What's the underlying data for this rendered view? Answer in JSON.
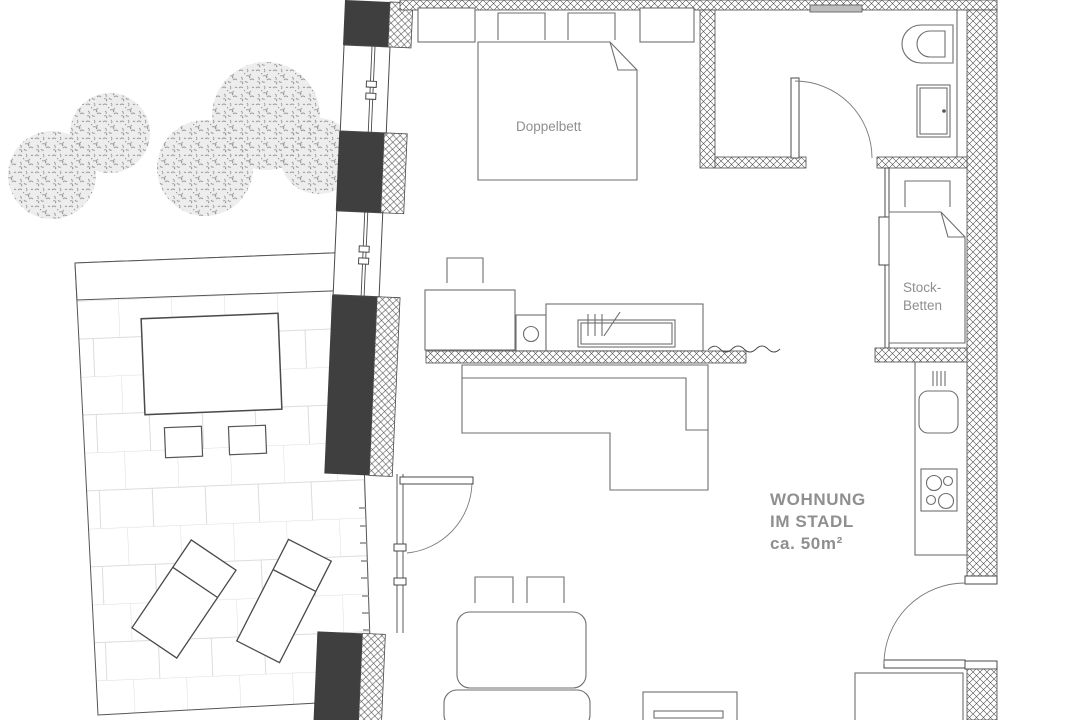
{
  "title_block": {
    "line1": "WOHNUNG",
    "line2": "IM STADL",
    "line3": "ca. 50m²"
  },
  "room_labels": {
    "double_bed": "Doppelbett",
    "bunk_beds_line1": "Stock-",
    "bunk_beds_line2": "Betten"
  },
  "colors": {
    "wall_fill": "#3f3f3f",
    "wall_line": "#4a4a4a",
    "furniture_line": "#6e6e6e",
    "label_text": "#8f8f8f",
    "paving_line": "#dcdcdc",
    "tree_speckle": "#9a9a9a",
    "tree_fill": "#ededed",
    "background": "#ffffff"
  }
}
